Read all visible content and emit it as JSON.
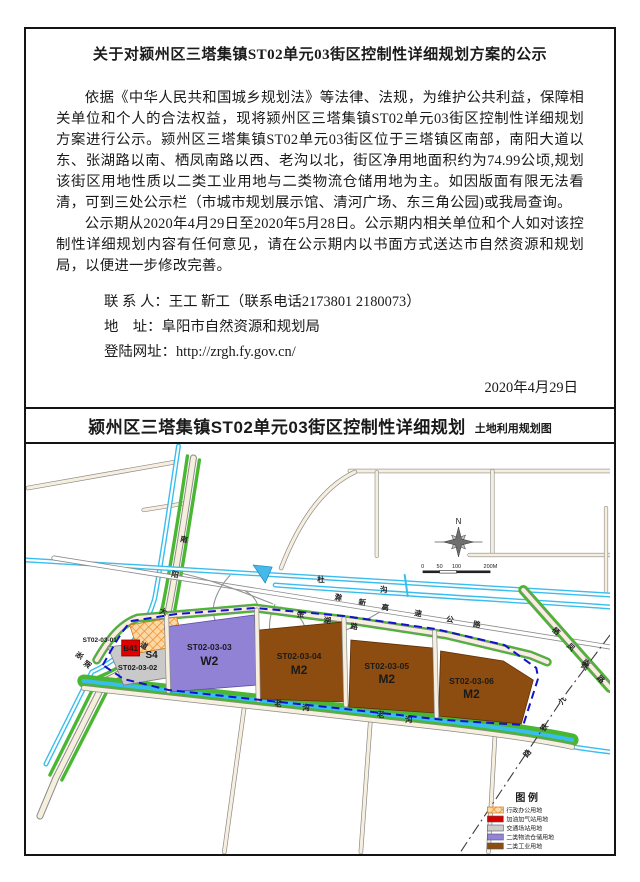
{
  "notice": {
    "title": "关于对颍州区三塔集镇ST02单元03街区控制性详细规划方案的公示",
    "para1": "依据《中华人民共和国城乡规划法》等法律、法规，为维护公共利益，保障相关单位和个人的合法权益，现将颍州区三塔集镇ST02单元03街区控制性详细规划方案进行公示。颍州区三塔集镇ST02单元03街区位于三塔镇区南部，南阳大道以东、张湖路以南、栖凤南路以西、老沟以北，街区净用地面积约为74.99公顷,规划该街区用地性质以二类工业用地与二类物流仓储用地为主。如因版面有限无法看清，可到三处公示栏（市城市规划展示馆、清河广场、东三角公园)或我局查询。",
    "para2": "公示期从2020年4月29日至2020年5月28日。公示期内相关单位和个人如对该控制性详细规划内容有任何意见，请在公示期内以书面方式送达市自然资源和规划局，以便进一步修改完善。",
    "contact_person_label": "联 系 人：",
    "contact_person": "王工  靳工（联系电话2173801  2180073）",
    "address_label": "地    址：",
    "address": "阜阳市自然资源和规划局",
    "website_label": "登陆网址：",
    "website": "http://zrgh.fy.gov.cn/",
    "date": "2020年4月29日"
  },
  "map": {
    "title": "颍州区三塔集镇ST02单元03街区控制性详细规划",
    "subtitle": "土地利用规划图",
    "compass_n": "N",
    "scale": {
      "t0": "0",
      "t50": "50",
      "t100": "100",
      "t200": "200M"
    },
    "zones": {
      "z01_code": "ST02-03-01",
      "z01_b41": "B41",
      "z02_type": "S4",
      "z02_code": "ST02-03-02",
      "z03_code": "ST02-03-03",
      "z03_type": "W2",
      "z04_code": "ST02-03-04",
      "z04_type": "M2",
      "z05_code": "ST02-03-05",
      "z05_type": "M2",
      "z06_code": "ST02-03-06",
      "z06_type": "M2"
    },
    "colors": {
      "warehouse": "#9182d6",
      "industry": "#8d4c10",
      "transport": "#c9c9c9",
      "gas_station": "#e00000",
      "boundary": "#1212cc"
    },
    "roads": {
      "nanyang": "南阳大道",
      "nanyang_chars": [
        "南",
        "阳",
        "大",
        "道"
      ],
      "zhanghu": "张湖路",
      "zhanghu_chars": [
        "张",
        "湖",
        "路"
      ],
      "laogou": "老沟",
      "laogou_chars": [
        "老",
        "沟"
      ],
      "qifeng": "栖凤南路",
      "qifeng_chars": [
        "栖",
        "凤",
        "南",
        "路"
      ],
      "expressway": "滁新高速公路",
      "expressway_chars": [
        "滁",
        "新",
        "高",
        "速",
        "公",
        "路"
      ],
      "railway": "京九铁路",
      "railway_chars": [
        "京",
        "九",
        "铁",
        "路"
      ],
      "river": "杜沟",
      "river_chars": [
        "杜",
        "沟"
      ]
    },
    "legend": {
      "title": "图  例",
      "items": [
        {
          "label": "行政办公用地",
          "color": "hatch-orange"
        },
        {
          "label": "加油加气站用地",
          "color": "#d40000"
        },
        {
          "label": "交通场站用地",
          "color": "#cccccc"
        },
        {
          "label": "二类物流仓储用地",
          "color": "#9383d9"
        },
        {
          "label": "二类工业用地",
          "color": "#8d4c10"
        }
      ]
    }
  }
}
